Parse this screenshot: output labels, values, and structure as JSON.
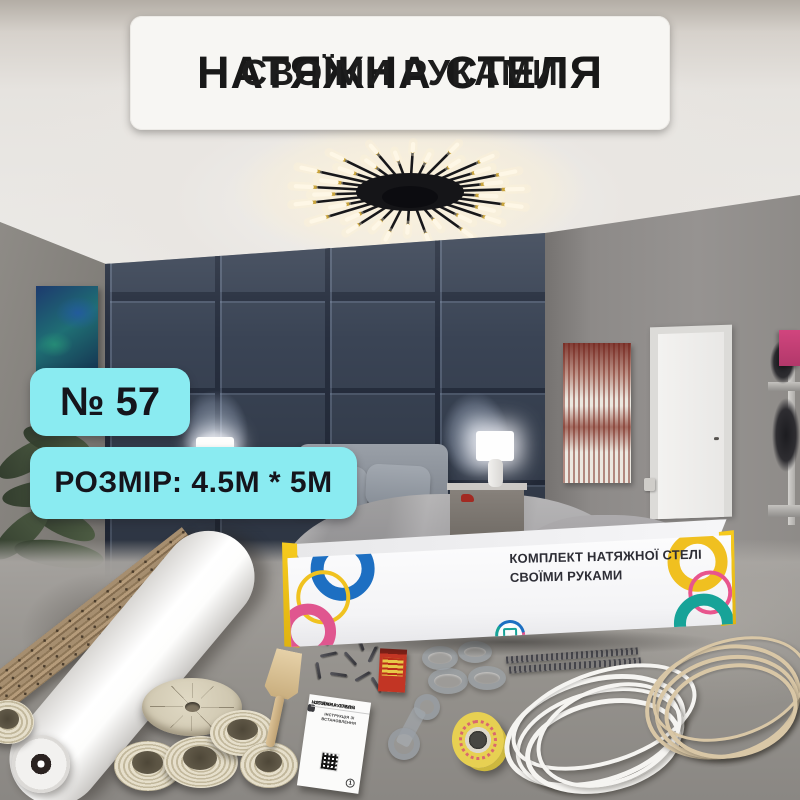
{
  "banner": {
    "line1": "НАТЯЖНА СТЕЛЯ",
    "line2": "СВОЇМИ РУКАМИ"
  },
  "badges": {
    "number": "№ 57",
    "size": "РОЗМІР: 4.5М * 5М"
  },
  "box": {
    "line1": "КОМПЛЕКТ НАТЯЖНОЇ СТЕЛІ",
    "line2": "СВОЇМИ РУКАМИ"
  },
  "instruction_sheet": {
    "title1": "НАТЯЖНА СТЕЛЯ",
    "title2": "«СВОЇМИ РУКАМИ»",
    "subtitle": "ІНСТРУКЦІЯ ЗІ ВСТАНОВЛЕННЯ",
    "page": "1"
  },
  "colors": {
    "badge_bg": "#8AEBF1",
    "badge_text": "#15151C",
    "banner_bg": "#F7F6F3",
    "banner_text": "#181818",
    "box_yellow": "#F2C418",
    "box_blue": "#1D6FC2",
    "box_pink": "#E0568F",
    "box_teal": "#17A398",
    "wall_navy": "#3A4455"
  }
}
